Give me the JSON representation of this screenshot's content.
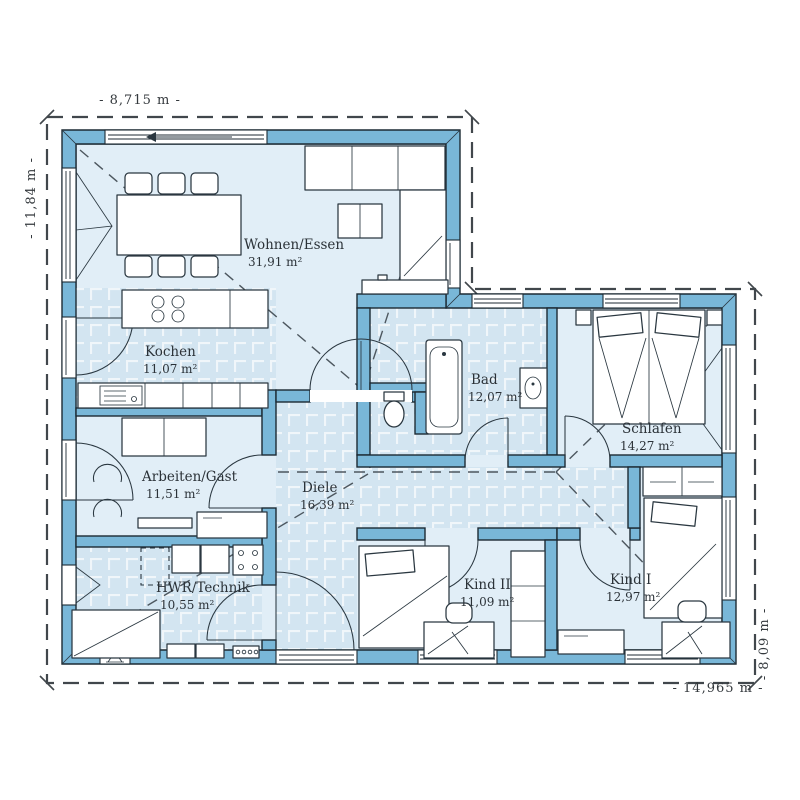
{
  "dimensions": {
    "top": "- 8,715 m -",
    "left": "- 11,84 m -",
    "bottom": "- 14,965 m -",
    "right": "- 8,09 m -"
  },
  "rooms": [
    {
      "name": "Wohnen/Essen",
      "area": "31,91 m²"
    },
    {
      "name": "Kochen",
      "area": "11,07 m²"
    },
    {
      "name": "Arbeiten/Gast",
      "area": "11,51 m²"
    },
    {
      "name": "HWR/Technik",
      "area": "10,55 m²"
    },
    {
      "name": "Diele",
      "area": "16,39 m²"
    },
    {
      "name": "Bad",
      "area": "12,07 m²"
    },
    {
      "name": "Schlafen",
      "area": "14,27 m²"
    },
    {
      "name": "Kind II",
      "area": "11,09 m²"
    },
    {
      "name": "Kind I",
      "area": "12,97 m²"
    }
  ],
  "colors": {
    "wall": "#79b7d8",
    "room_floor": "#e1eef7",
    "tile_floor": "#d3e5f1",
    "tile_grout": "#f0f6fa",
    "outline": "#1c2a33",
    "boundary_dash": "#41474c",
    "text": "#2b3238"
  }
}
